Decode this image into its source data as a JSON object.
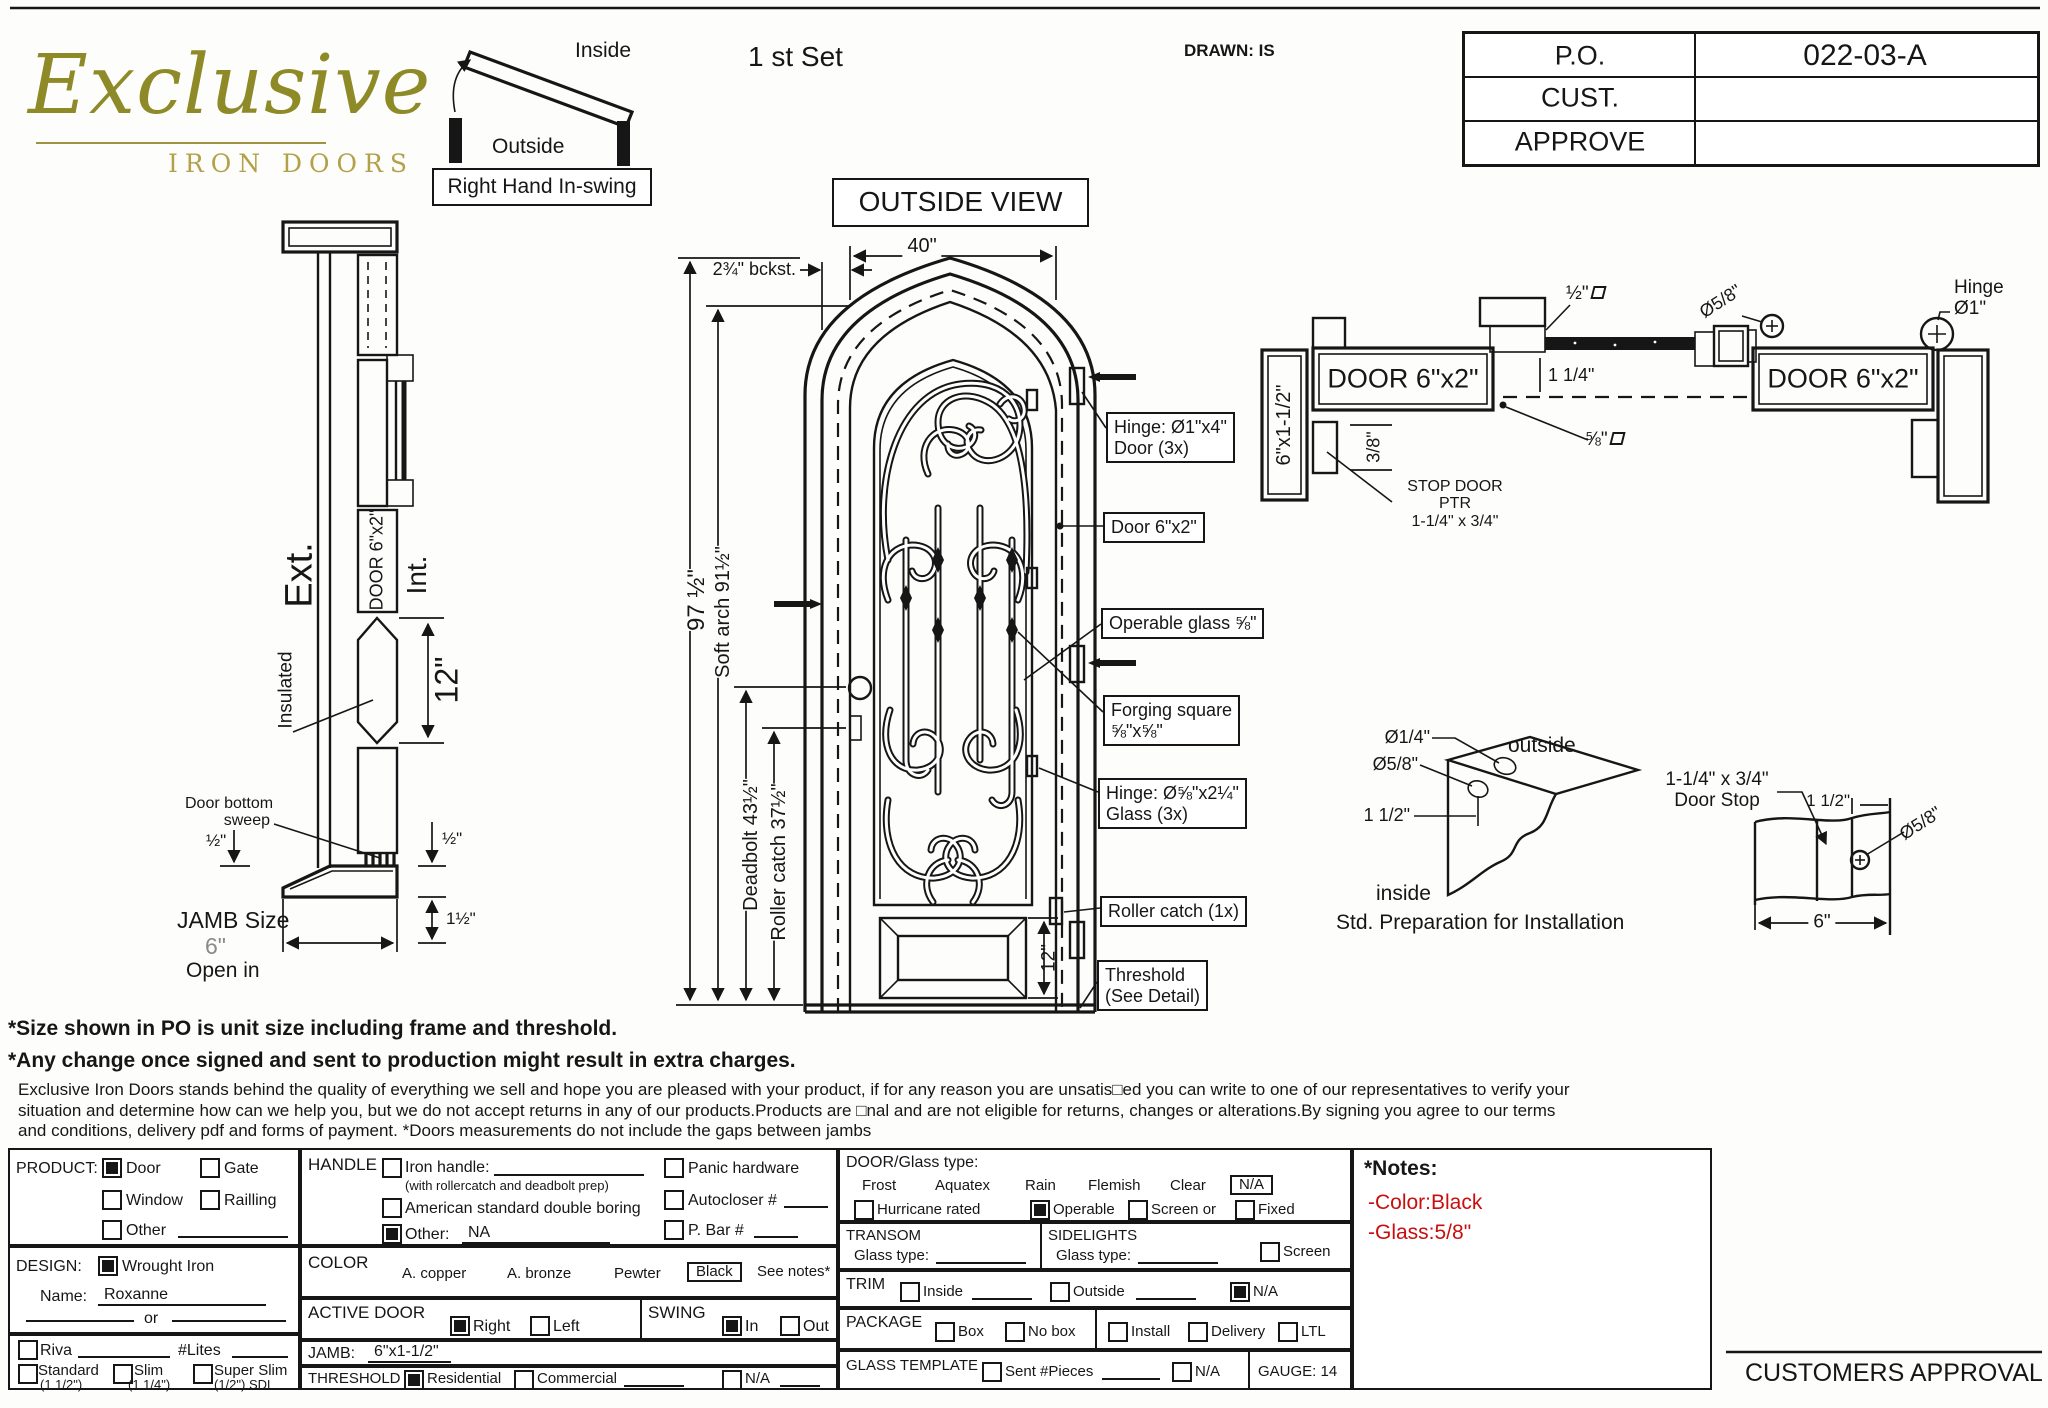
{
  "header": {
    "logo": {
      "line1": "Exclusive",
      "line2": "IRON DOORS"
    },
    "swing_diagram": {
      "inside": "Inside",
      "outside": "Outside",
      "label": "Right Hand In-swing"
    },
    "set_label": "1 st Set",
    "drawn": "DRAWN: IS",
    "view_title": "OUTSIDE VIEW",
    "po_table": {
      "po_label": "P.O.",
      "po_value": "022-03-A",
      "cust_label": "CUST.",
      "cust_value": "",
      "approve_label": "APPROVE",
      "approve_value": ""
    }
  },
  "section_view": {
    "ext": "Ext.",
    "int": "Int.",
    "door_label": "DOOR 6\"x2\"",
    "insulated": "Insulated",
    "glass_height": "12\"",
    "sweep_line1": "Door bottom",
    "sweep_line2": "sweep",
    "dim_half_left": "½\"",
    "dim_half_right": "½\"",
    "dim_one_half": "1½\"",
    "jamb_size_label": "JAMB Size",
    "jamb_size_value": "6\"",
    "open_in": "Open in"
  },
  "elevation": {
    "backset": "2¾\" bckst.",
    "width": "40\"",
    "height": "97 ½\"",
    "soft_arch": "Soft arch 91½\"",
    "deadbolt": "Deadbolt 43½\"",
    "roller_catch_dim": "Roller catch 37½\"",
    "panel_height": "12\"",
    "callouts": {
      "hinge_door_1": "Hinge: Ø1\"x4\"",
      "hinge_door_2": "Door (3x)",
      "door": "Door 6\"x2\"",
      "operable_glass": "Operable glass ⅝\"",
      "forging_1": "Forging square",
      "forging_2": "⅝\"x⅝\"",
      "hinge_glass_1": "Hinge: Ø⅝\"x2¼\"",
      "hinge_glass_2": "Glass (3x)",
      "roller": "Roller catch  (1x)",
      "threshold_1": "Threshold",
      "threshold_2": "(See Detail)"
    }
  },
  "plan_view": {
    "jamb_left": "6\"x1-1/2\"",
    "door_left": "DOOR 6\"x2\"",
    "door_right": "DOOR 6\"x2\"",
    "stop_door_1": "STOP DOOR",
    "stop_door_2": "PTR",
    "stop_door_3": "1-1/4\" x 3/4\"",
    "dim_three_eighths": "3/8\"",
    "dim_one_quarter": "1 1/4\"",
    "dim_half_sq": "½\"",
    "dim_five_eighths_sq": "⅝\"",
    "dia_five_eighths": "Ø5/8\"",
    "hinge_label_1": "Hinge",
    "hinge_label_2": "Ø1\""
  },
  "prep_detail": {
    "dia_quarter": "Ø1/4\"",
    "dia_five_eighths": "Ø5/8\"",
    "dim": "1 1/2\"",
    "outside": "outside",
    "inside": "inside",
    "caption": "Std. Preparation for Installation"
  },
  "stop_detail": {
    "label_1": "1-1/4\" x 3/4\"",
    "label_2": "Door Stop",
    "dim_one_half": "1 1/2\"",
    "dia": "Ø5/8\"",
    "width": "6\""
  },
  "notes": {
    "line1": "*Size shown in PO is unit size including frame and threshold.",
    "line2": "*Any change once signed and sent to production might result in extra charges.",
    "paragraph": "Exclusive Iron Doors stands behind the quality of everything we sell and hope you are pleased with your product, if for any reason you are unsatis□ed you can write to one of our representatives to verify your situation and determine how can we help you, but we do not accept returns in any of our products.Products are □nal and are not eligible for returns, changes or alterations.By signing you agree to our terms and conditions, delivery pdf and forms of payment. *Doors measurements do not include the gaps between jambs"
  },
  "form": {
    "product": {
      "label": "PRODUCT:",
      "door": "Door",
      "gate": "Gate",
      "window": "Window",
      "railling": "Railling",
      "other": "Other",
      "checked": {
        "door": true,
        "gate": false,
        "window": false,
        "railling": false,
        "other": false
      }
    },
    "design": {
      "label": "DESIGN:",
      "wrought": "Wrought Iron",
      "wrought_checked": true,
      "name_label": "Name:",
      "name_value": "Roxanne",
      "or": "or",
      "riva": "Riva",
      "riva_checked": false,
      "lites": "#Lites",
      "standard": "Standard",
      "standard_sub": "(1 1/2\")",
      "slim": "Slim",
      "slim_sub": "(1 1/4\")",
      "super_slim": "Super Slim",
      "super_slim_sub": "(1/2\") SDL"
    },
    "handle": {
      "label": "HANDLE",
      "iron": "Iron handle:",
      "iron_note": "(with rollercatch and deadbolt prep)",
      "iron_checked": false,
      "american": "American standard double boring",
      "american_checked": false,
      "other": "Other:",
      "other_checked": true,
      "other_value": "NA",
      "panic": "Panic hardware",
      "panic_checked": false,
      "autocloser": "Autocloser #",
      "autocloser_checked": false,
      "pbar": "P. Bar #",
      "pbar_checked": false
    },
    "color": {
      "label": "COLOR",
      "opt1": "A. copper",
      "opt2": "A. bronze",
      "opt3": "Pewter",
      "selected": "Black",
      "see_notes": "See notes*"
    },
    "active_door": {
      "label": "ACTIVE DOOR",
      "right": "Right",
      "right_checked": true,
      "left": "Left",
      "left_checked": false
    },
    "swing": {
      "label": "SWING",
      "in": "In",
      "in_checked": true,
      "out": "Out",
      "out_checked": false
    },
    "jamb": {
      "label": "JAMB:",
      "value": "6\"x1-1/2\""
    },
    "threshold": {
      "label": "THRESHOLD",
      "residential": "Residential",
      "residential_checked": true,
      "commercial": "Commercial",
      "commercial_checked": false,
      "na": "N/A",
      "na_checked": false
    },
    "glass": {
      "label": "DOOR/Glass type:",
      "t1": "Frost",
      "t2": "Aquatex",
      "t3": "Rain",
      "t4": "Flemish",
      "t5": "Clear",
      "selected": "N/A",
      "hurricane": "Hurricane rated",
      "hurricane_checked": false,
      "operable": "Operable",
      "operable_checked": true,
      "screen_or": "Screen or",
      "screen_checked": false,
      "fixed": "Fixed",
      "fixed_checked": false
    },
    "transom": {
      "label": "TRANSOM",
      "glass_label": "Glass type:"
    },
    "sidelights": {
      "label": "SIDELIGHTS",
      "glass_label": "Glass type:",
      "screen": "Screen",
      "screen_checked": false
    },
    "trim": {
      "label": "TRIM",
      "inside": "Inside",
      "inside_checked": false,
      "outside": "Outside",
      "outside_checked": false,
      "na": "N/A",
      "na_checked": true
    },
    "package": {
      "label": "PACKAGE",
      "box": "Box",
      "nobox": "No box",
      "install": "Install",
      "delivery": "Delivery",
      "ltl": "LTL",
      "checked": {
        "box": false,
        "nobox": false,
        "install": false,
        "delivery": false,
        "ltl": false
      }
    },
    "glass_template": {
      "label": "GLASS TEMPLATE",
      "sent": "Sent #Pieces",
      "sent_checked": false,
      "na": "N/A",
      "na_checked": false,
      "gauge": "GAUGE: 14"
    }
  },
  "side_notes": {
    "title": "*Notes:",
    "color_note": "-Color:Black",
    "glass_note": "-Glass:5/8\"",
    "accent": "#c80f0f"
  },
  "approval": "CUSTOMERS APPROVAL"
}
